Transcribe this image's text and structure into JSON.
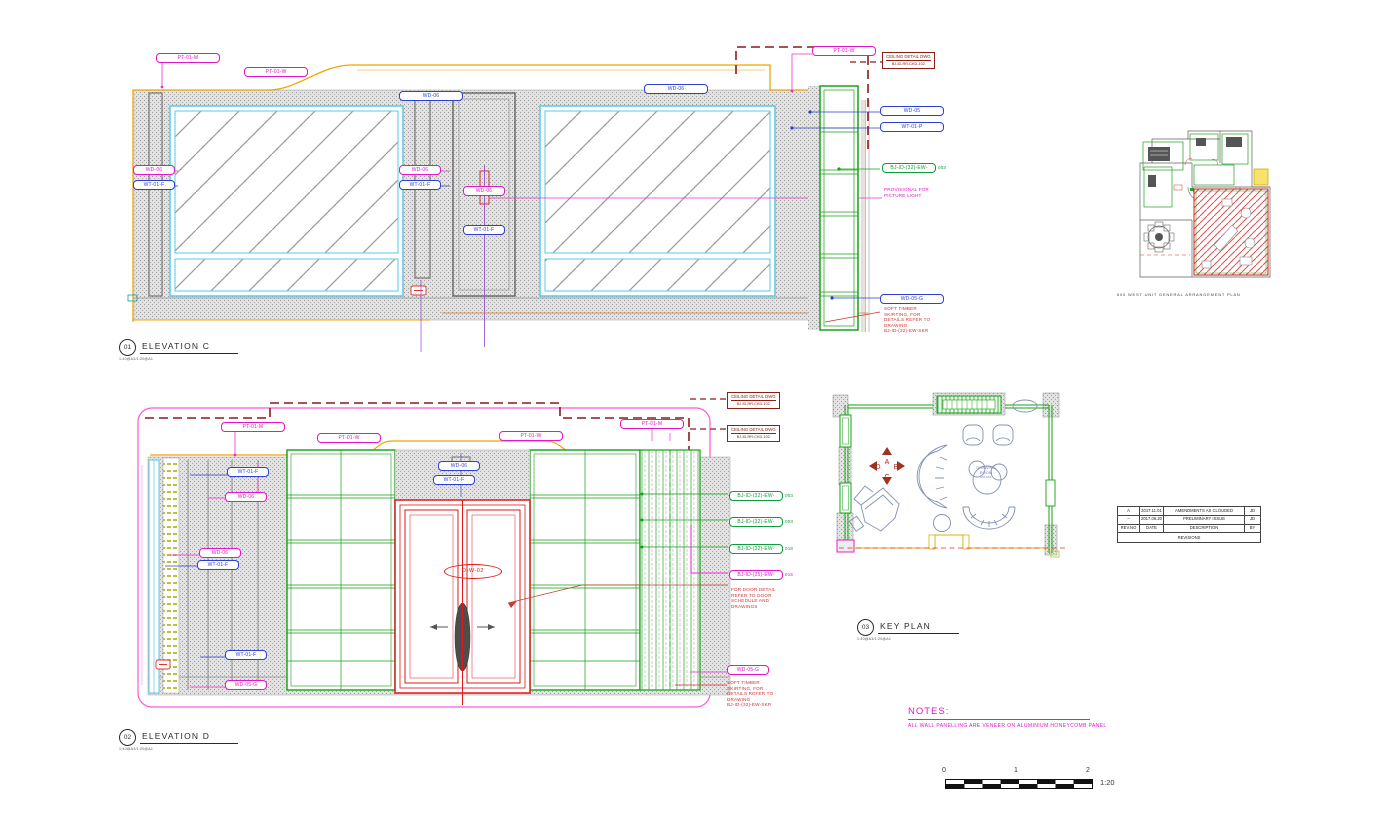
{
  "codes": {
    "pt01m": "PT-01-M",
    "pt01w": "PT-01-W",
    "wd05": "WD-05",
    "wd06": "WD-06",
    "wd05g": "WD-05-G",
    "wt01f": "WT-01-F",
    "wt01p": "WT-01-P"
  },
  "refs": {
    "ew32": "BJ-ID-(32)-EW-",
    "n003": "003",
    "n018": "018",
    "ew25": "BJ-ID-(25)-EW-",
    "n015": "015"
  },
  "ceiling_box": {
    "line1": "CEILING DETAIL DWG",
    "line2": "BJ-ID-RR-CKD-102"
  },
  "annotations": {
    "provisional": "PROVISIONAL FOR\nPICTURE LIGHT",
    "skirting": "SOFT TIMBER\nSKIRTING, FOR\nDETAILS REFER TO\nDRAWING\nBJ-ID-(32)-EW-SKR",
    "door_detail": "FOR DOOR DETAIL\nREFER TO DOOR\nSCHEDULE AND\nDRAWINGS"
  },
  "door_tag": "D-W-02",
  "titles": {
    "c_num": "01",
    "c_name": "ELEVATION C",
    "d_num": "02",
    "d_name": "ELEVATION D",
    "k_num": "03",
    "k_name": "KEY PLAN",
    "scale_note": "1:40@A3/1:20@A1"
  },
  "key_plan": {
    "room_line1": "DRAWING",
    "room_line2": "ROOM",
    "room_code": "RM-05A",
    "dir": {
      "a": "A",
      "b": "B",
      "c": "C",
      "d": "D"
    }
  },
  "ga_caption": "600 WEST UNIT GENERAL ARRANGEMENT PLAN",
  "revisions": {
    "title": "REVISIONS",
    "headers": {
      "rev": "REV.NO",
      "date": "DATE",
      "desc": "DESCRIPTION",
      "by": "BY"
    },
    "rows": [
      {
        "rev": "A",
        "date": "2017.11.01",
        "desc": "AMENDMENTS AS CLOUDED",
        "by": "JD"
      },
      {
        "rev": "–",
        "date": "2017.06.20",
        "desc": "PRELIMINARY ISSUE",
        "by": "JD"
      }
    ]
  },
  "notes": {
    "title": "NOTES:",
    "body": "ALL WALL PANELLING ARE VENEER ON ALUMINIUM HONEYCOMB PANEL"
  },
  "scale_bar": {
    "t0": "0",
    "t1": "1",
    "t2": "2",
    "ratio": "1:20"
  }
}
